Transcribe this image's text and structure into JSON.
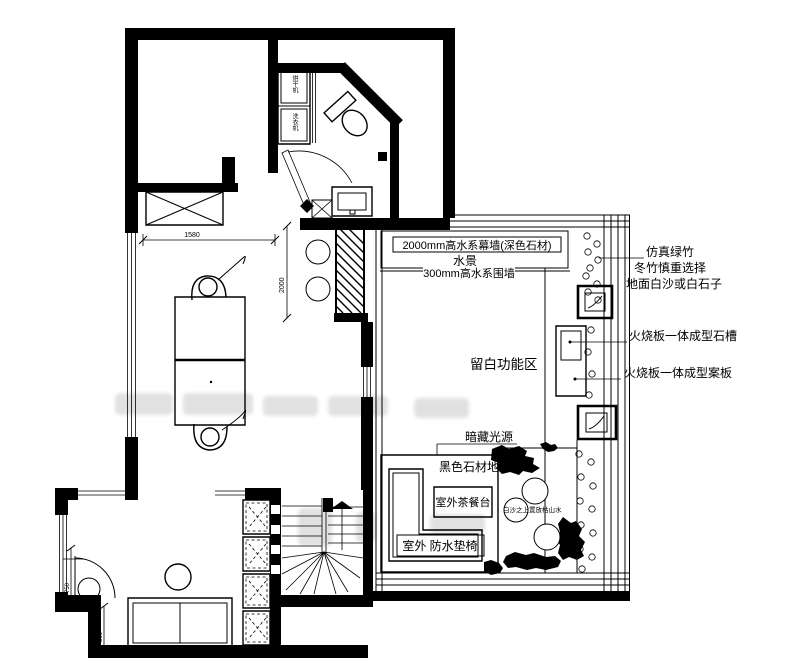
{
  "annotations": {
    "water_wall_label": "2000mm高水系幕墙(深色石材)",
    "water_scene": "水景",
    "water_fence": "300mm高水系围墙",
    "fake_bamboo": "仿真绿竹",
    "bamboo_note": "冬竹慎重选择",
    "ground_note": "地面白沙或白石子",
    "stone_sink": "火烧板一体成型石槽",
    "stone_board": "火烧板一体成型案板",
    "blank_zone": "留白功能区",
    "hidden_light": "暗藏光源",
    "black_stone_base": "黑色石材地台",
    "tea_table": "室外茶餐台",
    "waterproof_seat": "室外 防水垫椅",
    "karesansui_note": "白沙之上置放枯山水",
    "dryer": "烘干机",
    "washer": "洗衣机"
  },
  "dimensions": {
    "d1580": "1580",
    "d2000": "2000",
    "d750": "750",
    "d852": "852",
    "d800": "800"
  },
  "colors": {
    "ink": "#000000",
    "paper": "#ffffff",
    "watermark": "#c9c9c9"
  }
}
